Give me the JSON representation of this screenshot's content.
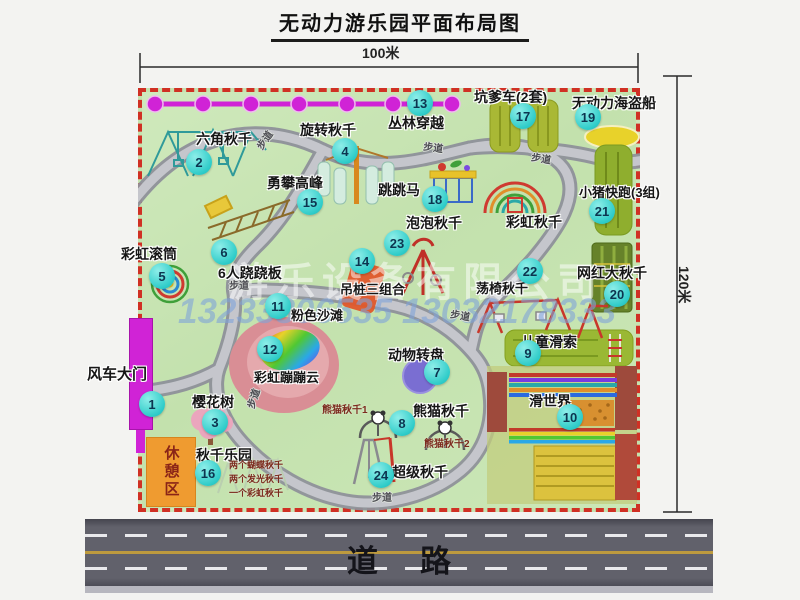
{
  "title": "无动力游乐园平面布局图",
  "dimensions": {
    "width": "100米",
    "height": "120米"
  },
  "road": {
    "label": "道路"
  },
  "rest_area": {
    "label": "休憩区"
  },
  "watermark": {
    "company": "游乐设备有限公司",
    "phone": "13233806535 13032178333"
  },
  "colors": {
    "badge_cyan": "#2fccc9",
    "border_red": "#d03024",
    "map_green": "#c8e4b2",
    "gate_magenta": "#d023d6",
    "rest_orange": "#ef9b30",
    "road_gray": "#61616b"
  },
  "map": {
    "attractions": [
      {
        "num": 1,
        "name": "风车大门",
        "label": {
          "x": 87,
          "y": 367,
          "size": 15
        },
        "badge": {
          "x": 152,
          "y": 404
        }
      },
      {
        "num": 2,
        "name": "六角秋千",
        "label": {
          "x": 196,
          "y": 132,
          "size": 14
        },
        "badge": {
          "x": 199,
          "y": 162
        }
      },
      {
        "num": 3,
        "name": "樱花树",
        "label": {
          "x": 192,
          "y": 395,
          "size": 14
        },
        "badge": {
          "x": 215,
          "y": 422
        }
      },
      {
        "num": 4,
        "name": "旋转秋千",
        "label": {
          "x": 300,
          "y": 123,
          "size": 14
        },
        "badge": {
          "x": 345,
          "y": 151
        }
      },
      {
        "num": 5,
        "name": "彩虹滚筒",
        "label": {
          "x": 121,
          "y": 247,
          "size": 14
        },
        "badge": {
          "x": 162,
          "y": 276
        }
      },
      {
        "num": 6,
        "name": "6人跷跷板",
        "label": {
          "x": 218,
          "y": 266,
          "size": 14
        },
        "badge": {
          "x": 224,
          "y": 252
        }
      },
      {
        "num": 7,
        "name": "动物转盘",
        "label": {
          "x": 388,
          "y": 348,
          "size": 14
        },
        "badge": {
          "x": 437,
          "y": 372
        }
      },
      {
        "num": 8,
        "name": "熊猫秋千",
        "label": {
          "x": 413,
          "y": 404,
          "size": 14
        },
        "badge": {
          "x": 402,
          "y": 423
        }
      },
      {
        "num": 9,
        "name": "儿童滑索",
        "label": {
          "x": 521,
          "y": 335,
          "size": 14
        },
        "badge": {
          "x": 528,
          "y": 353
        }
      },
      {
        "num": 10,
        "name": "滑世界",
        "label": {
          "x": 529,
          "y": 394,
          "size": 14
        },
        "badge": {
          "x": 570,
          "y": 417
        }
      },
      {
        "num": 11,
        "name": "粉色沙滩",
        "label": {
          "x": 291,
          "y": 309,
          "size": 13
        },
        "badge": {
          "x": 278,
          "y": 306
        }
      },
      {
        "num": 12,
        "name": "彩虹蹦蹦云",
        "label": {
          "x": 254,
          "y": 371,
          "size": 13
        },
        "badge": {
          "x": 270,
          "y": 349
        }
      },
      {
        "num": 13,
        "name": "丛林穿越",
        "label": {
          "x": 388,
          "y": 116,
          "size": 14
        },
        "badge": {
          "x": 420,
          "y": 103
        }
      },
      {
        "num": 14,
        "name": "吊桩三组合",
        "label": {
          "x": 340,
          "y": 283,
          "size": 13
        },
        "badge": {
          "x": 362,
          "y": 261
        }
      },
      {
        "num": 15,
        "name": "勇攀高峰",
        "label": {
          "x": 267,
          "y": 176,
          "size": 14
        },
        "badge": {
          "x": 310,
          "y": 202
        }
      },
      {
        "num": 16,
        "name": "秋千乐园",
        "label": {
          "x": 196,
          "y": 448,
          "size": 14
        },
        "badge": {
          "x": 208,
          "y": 473
        }
      },
      {
        "num": 17,
        "name": "坑爹车(2套)",
        "label": {
          "x": 474,
          "y": 90,
          "size": 14
        },
        "badge": {
          "x": 523,
          "y": 116
        }
      },
      {
        "num": 18,
        "name": "跳跳马",
        "label": {
          "x": 378,
          "y": 183,
          "size": 14
        },
        "badge": {
          "x": 435,
          "y": 199
        }
      },
      {
        "num": 19,
        "name": "无动力海盗船",
        "label": {
          "x": 572,
          "y": 96,
          "size": 14
        },
        "badge": {
          "x": 588,
          "y": 117
        }
      },
      {
        "num": 20,
        "name": "网红大秋千",
        "label": {
          "x": 577,
          "y": 266,
          "size": 14
        },
        "badge": {
          "x": 617,
          "y": 294
        }
      },
      {
        "num": 21,
        "name": "小猪快跑(3组)",
        "label": {
          "x": 579,
          "y": 186,
          "size": 13
        },
        "badge": {
          "x": 602,
          "y": 211
        }
      },
      {
        "num": 22,
        "name": "荡椅秋千",
        "label": {
          "x": 476,
          "y": 282,
          "size": 13
        },
        "badge": {
          "x": 530,
          "y": 271
        }
      },
      {
        "num": 23,
        "name": "泡泡秋千",
        "label": {
          "x": 406,
          "y": 216,
          "size": 14
        },
        "badge": {
          "x": 397,
          "y": 243
        }
      },
      {
        "num": 24,
        "name": "超级秋千",
        "label": {
          "x": 392,
          "y": 465,
          "size": 14
        },
        "badge": {
          "x": 381,
          "y": 475
        }
      },
      {
        "num": null,
        "name": "彩虹秋千",
        "label": {
          "x": 506,
          "y": 215,
          "size": 14
        },
        "badge": null
      }
    ],
    "sub_labels": [
      {
        "text": "熊猫秋千1",
        "x": 322,
        "y": 406,
        "size": 10
      },
      {
        "text": "熊猫秋千2",
        "x": 424,
        "y": 440,
        "size": 10
      },
      {
        "text": "两个蝴蝶秋千",
        "x": 229,
        "y": 461,
        "size": 9
      },
      {
        "text": "两个发光秋千",
        "x": 229,
        "y": 475,
        "size": 9
      },
      {
        "text": "一个彩虹秋千",
        "x": 229,
        "y": 489,
        "size": 9
      }
    ],
    "path_labels": [
      {
        "text": "步道",
        "x": 256,
        "y": 136,
        "rot": -55
      },
      {
        "text": "步道",
        "x": 423,
        "y": 144,
        "rot": 8
      },
      {
        "text": "步道",
        "x": 531,
        "y": 155,
        "rot": 10
      },
      {
        "text": "步道",
        "x": 229,
        "y": 282,
        "rot": 0
      },
      {
        "text": "步道",
        "x": 245,
        "y": 394,
        "rot": -72
      },
      {
        "text": "步道",
        "x": 450,
        "y": 312,
        "rot": 10
      },
      {
        "text": "步道",
        "x": 372,
        "y": 494,
        "rot": 0
      }
    ]
  }
}
